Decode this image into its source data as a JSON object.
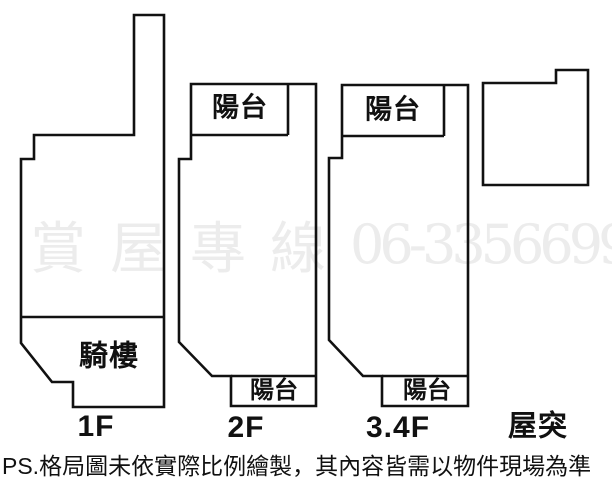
{
  "watermark": {
    "cjk": "賞屋專線",
    "number": "06-3356699",
    "color": "#ececec"
  },
  "disclaimer": {
    "text": "PS.格局圖未依實際比例繪製，其內容皆需以物件現場為準"
  },
  "colors": {
    "line": "#111111",
    "label": "#111111",
    "background": "#ffffff"
  },
  "floors": [
    {
      "label": "1F",
      "areas": {
        "arcade": "騎樓"
      }
    },
    {
      "label": "2F",
      "areas": {
        "balcony_top": "陽台",
        "balcony_bottom": "陽台"
      }
    },
    {
      "label": "3.4F",
      "areas": {
        "balcony_top": "陽台",
        "balcony_bottom": "陽台"
      }
    },
    {
      "label": "屋突"
    }
  ]
}
